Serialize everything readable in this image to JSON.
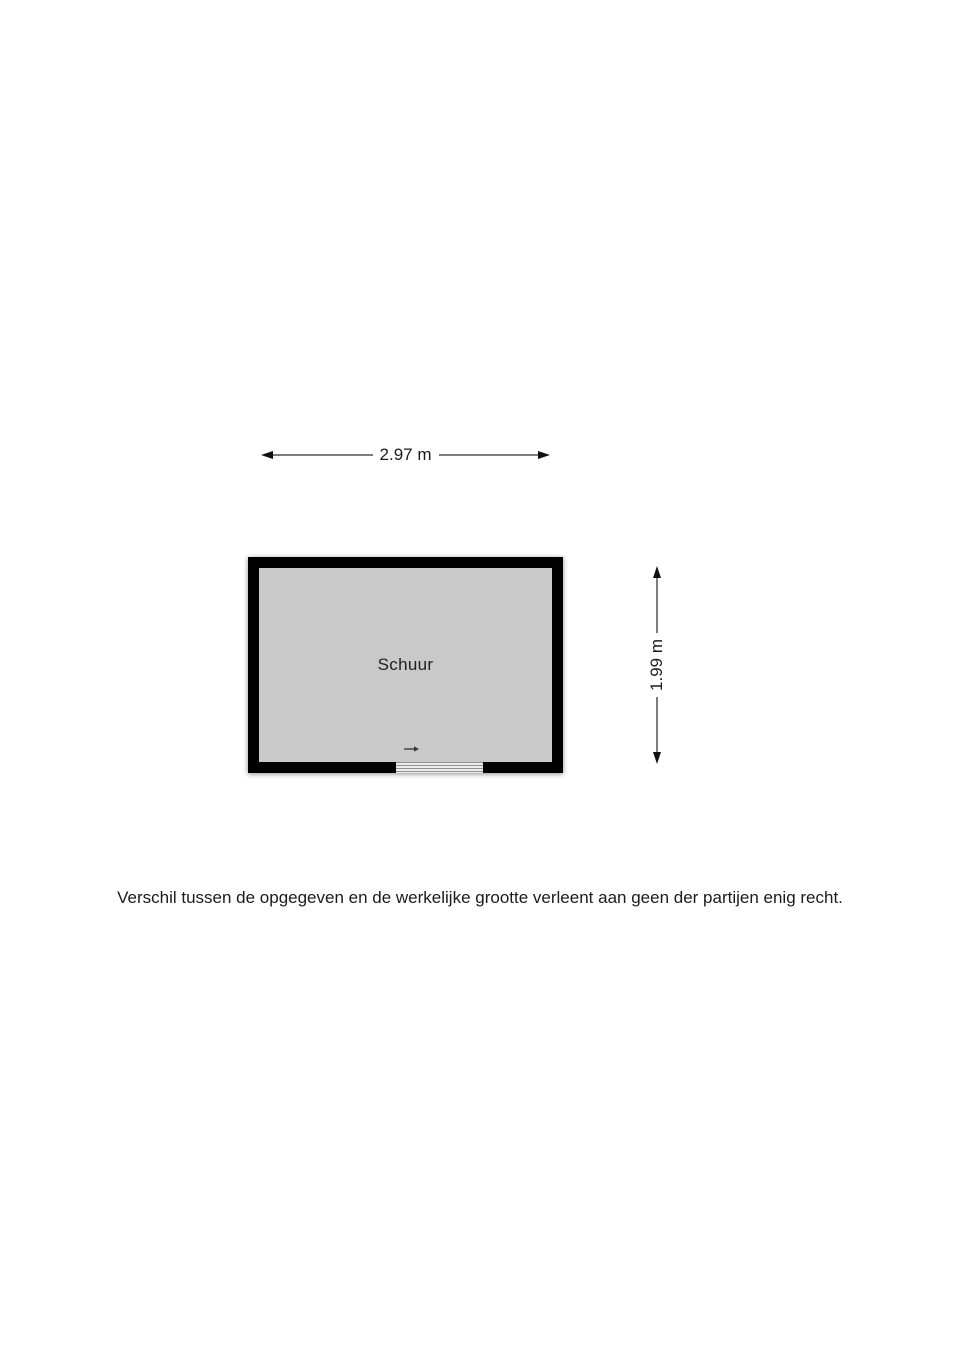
{
  "floorplan": {
    "room_label": "Schuur",
    "width_dimension": "2.97 m",
    "height_dimension": "1.99 m",
    "disclaimer": "Verschil tussen de opgegeven en de werkelijke grootte verleent aan geen der partijen enig recht.",
    "colors": {
      "wall": "#000000",
      "floor": "#c9c9c9",
      "dimension_line": "#7d7d7d",
      "arrowhead": "#111111",
      "text": "#1b1b1b",
      "background": "#ffffff"
    }
  }
}
